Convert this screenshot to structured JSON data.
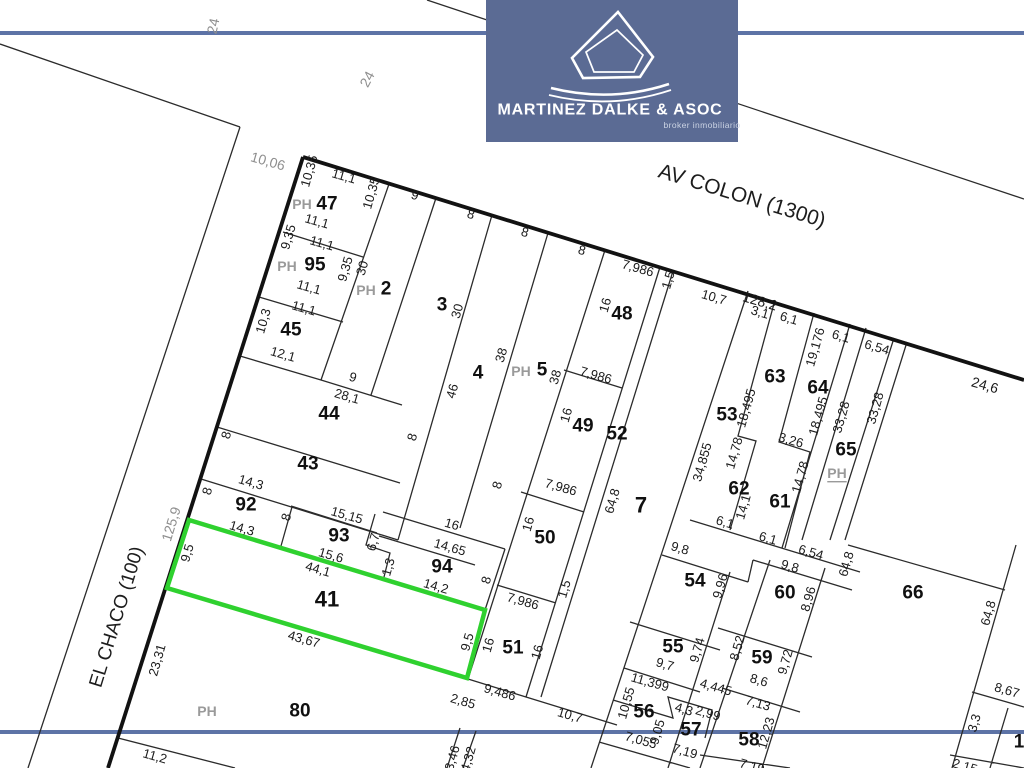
{
  "logo": {
    "title": "MARTINEZ DALKE & ASOC",
    "subtitle": "broker inmobiliario",
    "bg_color": "#5b6b94"
  },
  "colors": {
    "highlight": "#2fd12f",
    "blue_line": "#5d73a6",
    "line": "#2b2b2b",
    "thick_line": "#121212"
  },
  "highlighted_lot": "41",
  "lots": [
    "1",
    "2",
    "3",
    "4",
    "5",
    "7",
    "41",
    "43",
    "44",
    "45",
    "47",
    "48",
    "49",
    "50",
    "51",
    "52",
    "53",
    "54",
    "55",
    "56",
    "57",
    "58",
    "59",
    "60",
    "61",
    "62",
    "63",
    "64",
    "65",
    "66",
    "80",
    "92",
    "93",
    "94",
    "95"
  ],
  "map": {
    "labels": [
      {
        "t": "AV COLON (1300)",
        "x": 742,
        "y": 196,
        "r": 17,
        "k": "street",
        "s": 21
      },
      {
        "t": "EL CHACO (100)",
        "x": 117,
        "y": 617,
        "r": -73,
        "k": "street",
        "s": 19
      },
      {
        "t": "24",
        "x": 213,
        "y": 26,
        "r": -78,
        "k": "gray"
      },
      {
        "t": "24",
        "x": 367,
        "y": 79,
        "r": -62,
        "k": "gray"
      },
      {
        "t": "10,06",
        "x": 268,
        "y": 161,
        "r": 16,
        "k": "gray"
      },
      {
        "t": "125,9",
        "x": 171,
        "y": 524,
        "r": -73,
        "k": "gray"
      },
      {
        "t": "PH",
        "x": 302,
        "y": 204,
        "k": "ph"
      },
      {
        "t": "47",
        "x": 327,
        "y": 204,
        "k": "lot"
      },
      {
        "t": "10,35",
        "x": 309,
        "y": 171,
        "r": -74
      },
      {
        "t": "11,1",
        "x": 344,
        "y": 176,
        "r": 16
      },
      {
        "t": "10,35",
        "x": 371,
        "y": 193,
        "r": -74
      },
      {
        "t": "11,1",
        "x": 317,
        "y": 221,
        "r": 16
      },
      {
        "t": "11,1",
        "x": 322,
        "y": 243,
        "r": 16
      },
      {
        "t": "9,35",
        "x": 288,
        "y": 237,
        "r": -74
      },
      {
        "t": "PH",
        "x": 287,
        "y": 266,
        "k": "ph"
      },
      {
        "t": "95",
        "x": 315,
        "y": 265,
        "k": "lot"
      },
      {
        "t": "11,1",
        "x": 309,
        "y": 287,
        "r": 16
      },
      {
        "t": "9,35",
        "x": 345,
        "y": 269,
        "r": -74
      },
      {
        "t": "30",
        "x": 362,
        "y": 268,
        "r": -74
      },
      {
        "t": "PH",
        "x": 366,
        "y": 290,
        "k": "ph"
      },
      {
        "t": "2",
        "x": 386,
        "y": 289,
        "k": "lot"
      },
      {
        "t": "11,1",
        "x": 304,
        "y": 308,
        "r": 16
      },
      {
        "t": "10,3",
        "x": 263,
        "y": 321,
        "r": -74
      },
      {
        "t": "45",
        "x": 291,
        "y": 330,
        "k": "lot"
      },
      {
        "t": "12,1",
        "x": 283,
        "y": 354,
        "r": 16
      },
      {
        "t": "9",
        "x": 415,
        "y": 195,
        "r": 16
      },
      {
        "t": "3",
        "x": 442,
        "y": 305,
        "k": "lot"
      },
      {
        "t": "30",
        "x": 457,
        "y": 311,
        "r": -74
      },
      {
        "t": "9",
        "x": 353,
        "y": 377,
        "r": 16
      },
      {
        "t": "28,1",
        "x": 347,
        "y": 396,
        "r": 16
      },
      {
        "t": "44",
        "x": 329,
        "y": 414,
        "k": "lot"
      },
      {
        "t": "8",
        "x": 226,
        "y": 435,
        "r": -74
      },
      {
        "t": "8",
        "x": 412,
        "y": 437,
        "r": -74
      },
      {
        "t": "43",
        "x": 308,
        "y": 464,
        "k": "lot"
      },
      {
        "t": "8",
        "x": 207,
        "y": 491,
        "r": -74
      },
      {
        "t": "14,3",
        "x": 251,
        "y": 482,
        "r": 16
      },
      {
        "t": "92",
        "x": 246,
        "y": 505,
        "k": "lot"
      },
      {
        "t": "14,3",
        "x": 242,
        "y": 528,
        "r": 16
      },
      {
        "t": "8",
        "x": 286,
        "y": 517,
        "r": -74
      },
      {
        "t": "15,15",
        "x": 347,
        "y": 515,
        "r": 16
      },
      {
        "t": "93",
        "x": 339,
        "y": 536,
        "k": "lot"
      },
      {
        "t": "15,6",
        "x": 331,
        "y": 555,
        "r": 16
      },
      {
        "t": "6,7",
        "x": 373,
        "y": 542,
        "r": -74
      },
      {
        "t": "1,3",
        "x": 388,
        "y": 567,
        "r": -74
      },
      {
        "t": "44,1",
        "x": 318,
        "y": 569,
        "r": 16
      },
      {
        "t": "16",
        "x": 452,
        "y": 524,
        "r": 16
      },
      {
        "t": "14,65",
        "x": 450,
        "y": 547,
        "r": 16
      },
      {
        "t": "94",
        "x": 442,
        "y": 567,
        "k": "lot"
      },
      {
        "t": "14,2",
        "x": 436,
        "y": 586,
        "r": 16
      },
      {
        "t": "8",
        "x": 486,
        "y": 580,
        "r": -74
      },
      {
        "t": "41",
        "x": 327,
        "y": 599,
        "k": "lotbig"
      },
      {
        "t": "9,5",
        "x": 187,
        "y": 553,
        "r": -74
      },
      {
        "t": "23,31",
        "x": 157,
        "y": 660,
        "r": -74
      },
      {
        "t": "43,67",
        "x": 304,
        "y": 639,
        "r": 16
      },
      {
        "t": "9,5",
        "x": 467,
        "y": 642,
        "r": -74
      },
      {
        "t": "16",
        "x": 488,
        "y": 645,
        "r": -74
      },
      {
        "t": "51",
        "x": 513,
        "y": 648,
        "k": "lot"
      },
      {
        "t": "16",
        "x": 537,
        "y": 652,
        "r": -74
      },
      {
        "t": "9,486",
        "x": 500,
        "y": 692,
        "r": 16
      },
      {
        "t": "2,85",
        "x": 463,
        "y": 701,
        "r": 16
      },
      {
        "t": "PH",
        "x": 207,
        "y": 711,
        "k": "ph"
      },
      {
        "t": "80",
        "x": 300,
        "y": 711,
        "k": "lot"
      },
      {
        "t": "11,2",
        "x": 155,
        "y": 756,
        "r": 16
      },
      {
        "t": "3,46",
        "x": 452,
        "y": 758,
        "r": -74
      },
      {
        "t": "4,32",
        "x": 468,
        "y": 759,
        "r": -74
      },
      {
        "t": "8",
        "x": 471,
        "y": 214,
        "r": 16
      },
      {
        "t": "8",
        "x": 525,
        "y": 232,
        "r": 16
      },
      {
        "t": "8",
        "x": 582,
        "y": 250,
        "r": 16
      },
      {
        "t": "46",
        "x": 452,
        "y": 391,
        "r": -74
      },
      {
        "t": "4",
        "x": 478,
        "y": 373,
        "k": "lot"
      },
      {
        "t": "38",
        "x": 501,
        "y": 355,
        "r": -74
      },
      {
        "t": "PH",
        "x": 521,
        "y": 371,
        "k": "ph"
      },
      {
        "t": "5",
        "x": 542,
        "y": 370,
        "k": "lot"
      },
      {
        "t": "38",
        "x": 555,
        "y": 377,
        "r": -74
      },
      {
        "t": "7,986",
        "x": 638,
        "y": 268,
        "r": 16
      },
      {
        "t": "1,5",
        "x": 668,
        "y": 280,
        "r": -74
      },
      {
        "t": "16",
        "x": 605,
        "y": 305,
        "r": -74
      },
      {
        "t": "48",
        "x": 622,
        "y": 314,
        "k": "lot"
      },
      {
        "t": "7,986",
        "x": 596,
        "y": 375,
        "r": 16
      },
      {
        "t": "16",
        "x": 566,
        "y": 415,
        "r": -74
      },
      {
        "t": "49",
        "x": 583,
        "y": 426,
        "k": "lot"
      },
      {
        "t": "52",
        "x": 617,
        "y": 434,
        "k": "lot"
      },
      {
        "t": "7,986",
        "x": 561,
        "y": 487,
        "r": 16
      },
      {
        "t": "16",
        "x": 528,
        "y": 524,
        "r": -74
      },
      {
        "t": "50",
        "x": 545,
        "y": 538,
        "k": "lot"
      },
      {
        "t": "8",
        "x": 497,
        "y": 485,
        "r": -74
      },
      {
        "t": "64,8",
        "x": 612,
        "y": 501,
        "r": -74
      },
      {
        "t": "7",
        "x": 641,
        "y": 505,
        "k": "lotbig"
      },
      {
        "t": "1,5",
        "x": 564,
        "y": 589,
        "r": -74
      },
      {
        "t": "7,986",
        "x": 523,
        "y": 601,
        "r": 16
      },
      {
        "t": "10,7",
        "x": 570,
        "y": 715,
        "r": 16
      },
      {
        "t": "128,2",
        "x": 760,
        "y": 301,
        "r": 16,
        "s": 14
      },
      {
        "t": "10,7",
        "x": 714,
        "y": 297,
        "r": 16
      },
      {
        "t": "3,1",
        "x": 760,
        "y": 312,
        "r": 16
      },
      {
        "t": "6,1",
        "x": 789,
        "y": 318,
        "r": 16
      },
      {
        "t": "19,176",
        "x": 815,
        "y": 347,
        "r": -74
      },
      {
        "t": "6,1",
        "x": 841,
        "y": 336,
        "r": 16
      },
      {
        "t": "6,54",
        "x": 877,
        "y": 347,
        "r": 16
      },
      {
        "t": "24,6",
        "x": 985,
        "y": 385,
        "r": 16,
        "s": 14
      },
      {
        "t": "53",
        "x": 727,
        "y": 415,
        "k": "lot"
      },
      {
        "t": "18,495",
        "x": 746,
        "y": 408,
        "r": -74
      },
      {
        "t": "63",
        "x": 775,
        "y": 377,
        "k": "lot"
      },
      {
        "t": "18,495",
        "x": 818,
        "y": 416,
        "r": -74
      },
      {
        "t": "64",
        "x": 818,
        "y": 388,
        "k": "lot"
      },
      {
        "t": "33,28",
        "x": 841,
        "y": 417,
        "r": -74
      },
      {
        "t": "33,28",
        "x": 875,
        "y": 408,
        "r": -74
      },
      {
        "t": "65",
        "x": 846,
        "y": 450,
        "k": "lot"
      },
      {
        "t": "PH",
        "x": 837,
        "y": 473,
        "k": "ph",
        "u": 1
      },
      {
        "t": "34,855",
        "x": 702,
        "y": 462,
        "r": -74
      },
      {
        "t": "14,78",
        "x": 734,
        "y": 453,
        "r": -74
      },
      {
        "t": "3,26",
        "x": 791,
        "y": 440,
        "r": 16
      },
      {
        "t": "14,78",
        "x": 800,
        "y": 477,
        "r": -74
      },
      {
        "t": "62",
        "x": 739,
        "y": 489,
        "k": "lot"
      },
      {
        "t": "61",
        "x": 780,
        "y": 502,
        "k": "lot"
      },
      {
        "t": "14,1",
        "x": 743,
        "y": 507,
        "r": -74
      },
      {
        "t": "6,1",
        "x": 725,
        "y": 522,
        "r": 16
      },
      {
        "t": "6,1",
        "x": 768,
        "y": 538,
        "r": 16
      },
      {
        "t": "6,54",
        "x": 811,
        "y": 552,
        "r": 16
      },
      {
        "t": "64,8",
        "x": 846,
        "y": 564,
        "r": -74
      },
      {
        "t": "9,8",
        "x": 680,
        "y": 548,
        "r": 16
      },
      {
        "t": "54",
        "x": 695,
        "y": 581,
        "k": "lot"
      },
      {
        "t": "9,96",
        "x": 720,
        "y": 586,
        "r": -74
      },
      {
        "t": "9,8",
        "x": 790,
        "y": 566,
        "r": 16
      },
      {
        "t": "60",
        "x": 785,
        "y": 593,
        "k": "lot"
      },
      {
        "t": "8,96",
        "x": 808,
        "y": 599,
        "r": -74
      },
      {
        "t": "66",
        "x": 913,
        "y": 593,
        "k": "lot"
      },
      {
        "t": "64,8",
        "x": 988,
        "y": 613,
        "r": -74
      },
      {
        "t": "55",
        "x": 673,
        "y": 647,
        "k": "lot"
      },
      {
        "t": "9,74",
        "x": 697,
        "y": 650,
        "r": -74
      },
      {
        "t": "9,7",
        "x": 665,
        "y": 664,
        "r": 16
      },
      {
        "t": "8,52",
        "x": 737,
        "y": 648,
        "r": -74
      },
      {
        "t": "59",
        "x": 762,
        "y": 658,
        "k": "lot"
      },
      {
        "t": "9,72",
        "x": 785,
        "y": 662,
        "r": -74
      },
      {
        "t": "8,6",
        "x": 759,
        "y": 680,
        "r": 16
      },
      {
        "t": "11,399",
        "x": 650,
        "y": 682,
        "r": 16
      },
      {
        "t": "4,445",
        "x": 716,
        "y": 687,
        "r": 16
      },
      {
        "t": "7,13",
        "x": 758,
        "y": 703,
        "r": 16
      },
      {
        "t": "10,55",
        "x": 626,
        "y": 703,
        "r": -74
      },
      {
        "t": "56",
        "x": 644,
        "y": 712,
        "k": "lot"
      },
      {
        "t": "9,05",
        "x": 657,
        "y": 732,
        "r": -74
      },
      {
        "t": "4,3",
        "x": 684,
        "y": 709,
        "r": 16
      },
      {
        "t": "2,99",
        "x": 708,
        "y": 713,
        "r": 16
      },
      {
        "t": "57",
        "x": 691,
        "y": 730,
        "k": "lot"
      },
      {
        "t": "7,055",
        "x": 641,
        "y": 740,
        "r": 16
      },
      {
        "t": "7,19",
        "x": 685,
        "y": 751,
        "r": 16
      },
      {
        "t": "58",
        "x": 749,
        "y": 740,
        "k": "lot"
      },
      {
        "t": "12,23",
        "x": 766,
        "y": 733,
        "r": -74
      },
      {
        "t": "7,19",
        "x": 752,
        "y": 766,
        "r": 16
      },
      {
        "t": "8,67",
        "x": 1007,
        "y": 690,
        "r": 16
      },
      {
        "t": "3,3",
        "x": 974,
        "y": 723,
        "r": -74
      },
      {
        "t": "2,15",
        "x": 965,
        "y": 766,
        "r": 16
      },
      {
        "t": "1",
        "x": 1019,
        "y": 742,
        "k": "lot"
      }
    ]
  }
}
